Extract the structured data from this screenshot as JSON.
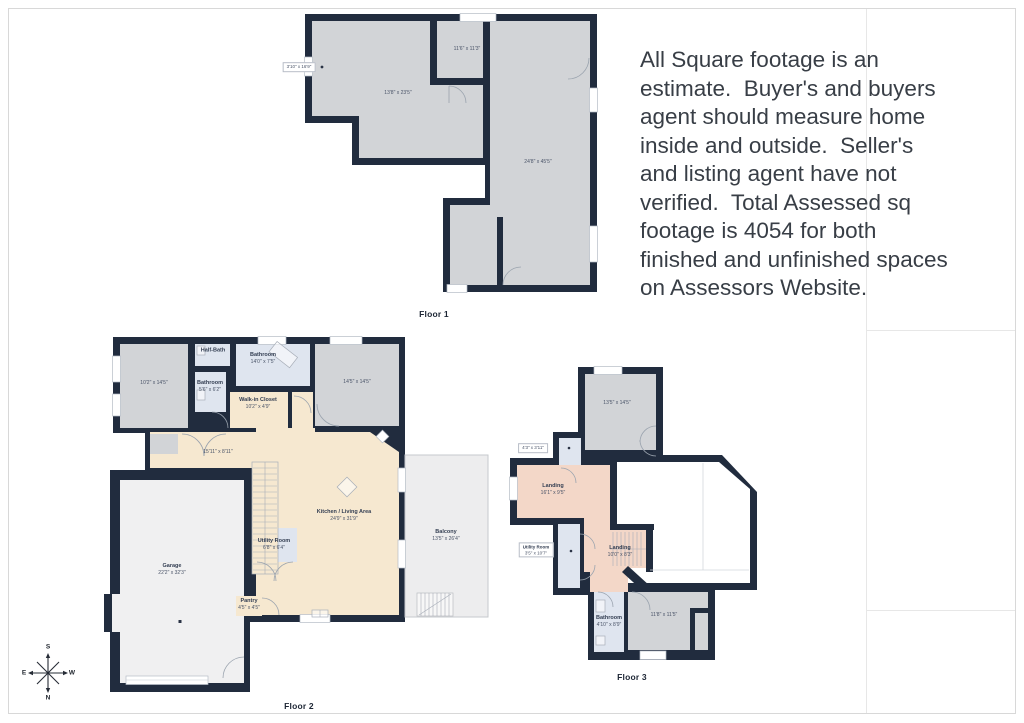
{
  "palette": {
    "wall": "#212c3e",
    "room_gray": "#d2d4d7",
    "room_tan": "#f6e8d0",
    "room_blue": "#dfe5ef",
    "room_salmon": "#f3d7c8",
    "garage": "#f0f0f1",
    "balcony": "#ededee",
    "text_dark": "#383e46"
  },
  "disclaimer": {
    "lines": [
      "All Square footage is an",
      "estimate.  Buyer's and buyers",
      "agent should measure home",
      "inside and outside.  Seller's",
      "and listing agent have not",
      "verified.  Total Assessed sq",
      "footage is 4054 for both",
      "finished and unfinished spaces",
      "on Assessors Website."
    ]
  },
  "floor1": {
    "label": "Floor 1",
    "room_mid": "11'6\" x 11'3\"",
    "room_left": "13'8\" x 23'5\"",
    "room_main": "24'8\" x 45'5\"",
    "outside_label": "3'10\" x 16'9\""
  },
  "floor2": {
    "label": "Floor 2",
    "bed_left": "10'2\" x 14'5\"",
    "halfbath": "Half-Bath",
    "bathroom1": {
      "name": "Bathroom",
      "dims": "14'0\" x 7'5\""
    },
    "bathroom2": {
      "name": "Bathroom",
      "dims": "5'6\" x 6'2\""
    },
    "closet": {
      "name": "Walk-in Closet",
      "dims": "10'2\" x 4'9\""
    },
    "bed_right": "14'5\" x 14'5\"",
    "hall": "15'11\" x 8'11\"",
    "kitchen": {
      "name": "Kitchen / Living Area",
      "dims": "24'9\" x 31'9\""
    },
    "utility": {
      "name": "Utility Room",
      "dims": "6'8\" x 6'4\""
    },
    "garage": {
      "name": "Garage",
      "dims": "22'2\" x 32'3\""
    },
    "pantry": {
      "name": "Pantry",
      "dims": "4'5\" x 4'5\""
    },
    "balcony": {
      "name": "Balcony",
      "dims": "13'5\" x 26'4\""
    }
  },
  "floor3": {
    "label": "Floor 3",
    "room_top": "13'5\" x 14'5\"",
    "outside_label": "4'3\" x 3'11\"",
    "landing1": {
      "name": "Landing",
      "dims": "16'1\" x 9'5\""
    },
    "utility": {
      "name": "Utility Room",
      "dims": "3'5\" x 10'7\""
    },
    "landing2": {
      "name": "Landing",
      "dims": "10'0\" x 8'3\""
    },
    "bathroom": {
      "name": "Bathroom",
      "dims": "4'10\" x 8'9\""
    },
    "room_br": "11'8\" x 11'5\""
  },
  "compass": {
    "n": "N",
    "s": "S",
    "e": "E",
    "w": "W"
  }
}
